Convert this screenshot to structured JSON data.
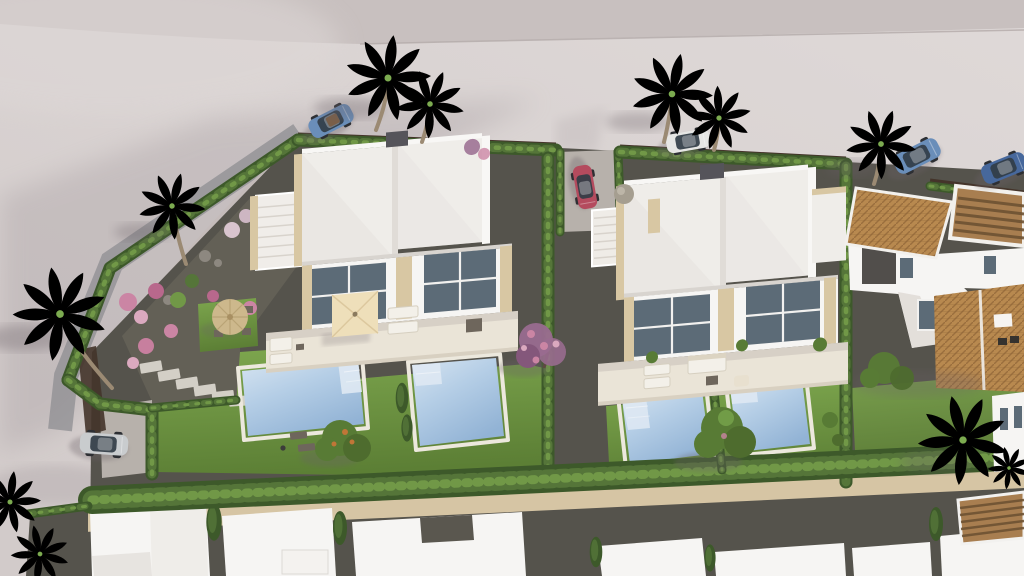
{
  "scene": {
    "description": "Aerial 3D architectural rendering of a Mediterranean residential development: two modern white semi-detached villas with private pools and lawns, cypress hedges, palm trees, gravel gardens with flowering shrubs, parked cars on a curved light-grey street, a terracotta-tile-roof house on the right and a row of flat white roofs along the bottom",
    "type": "3d-render-aerial-view",
    "visible_text": ""
  },
  "objects": {
    "villas": [
      "white-villa-left-two-units",
      "white-villa-right-two-units"
    ],
    "other_buildings": [
      "terracotta-roof-house-right",
      "flat-white-roofs-bottom-row"
    ],
    "pools": 4,
    "cars": [
      "blue-convertible",
      "white-hatchback",
      "red-compact",
      "silver-suv",
      "blue-suv",
      "dark-blue-suv"
    ],
    "vegetation": [
      "palm-trees",
      "cypress-hedges",
      "pink-bougainvillea",
      "green-trees",
      "lawns",
      "banana-plant"
    ],
    "garden_features": [
      "round-straw-parasol",
      "square-cream-parasol",
      "stepping-stones",
      "sun-loungers",
      "outdoor-sofa",
      "external-stairs",
      "stone-ball"
    ]
  },
  "palette": {
    "pavement": "#d2cbca",
    "pavementLight": "#ded8d7",
    "pavementShadow": "#9f959a",
    "topBand": "#c8c0bf",
    "curb": "#c3bbb8",
    "asphaltEdge": "#8e8d92",
    "gravel": "#55534c",
    "gravelLight": "#636056",
    "pebble": "#8d8880",
    "sand": "#d6c5a4",
    "lawnLight": "#7da64e",
    "lawnDark": "#5c7f35",
    "hedge": "#557539",
    "hedgeLight": "#719847",
    "hedgeDark": "#3d592a",
    "palm": "#5d8038",
    "palmDark": "#486a2c",
    "palmLight": "#7cab50",
    "trunk": "#9b8a73",
    "white": "#f6f5f3",
    "roofWhite": "#efede9",
    "roofShade": "#e0dcd7",
    "parapet": "#d8c7a3",
    "glazing": "#5c6b77",
    "frame": "#f2f1ef",
    "terrace": "#eae4d7",
    "terraceEdge": "#d8d0c1",
    "poolLight": "#d6e4f1",
    "poolMid": "#b5cee6",
    "poolDeep": "#92b3d5",
    "coping": "#ece8dd",
    "steps": "#dfe9f3",
    "terracotta": "#b8894f",
    "terracottaDark": "#8a5f33",
    "pergola": "#a87e50",
    "pergolaDark": "#6e5233",
    "fence": "#44342a",
    "carGlass": "#323d47",
    "carBlue": "#6a8eb9",
    "carDarkBlue": "#47689c",
    "carRed": "#b44b5e",
    "carSilver": "#c9ccce",
    "carWhite": "#e6e6e4",
    "treePurple": "#996b8f",
    "treePink": "#cb85a4",
    "treeGreen": "#587b35",
    "fruit": "#c07637",
    "shadow": "#6b6166",
    "concrete": "#b7b1ab",
    "stoneBall": "#a59e90",
    "furnDark": "#6e665c",
    "furnLight": "#f3f0e9",
    "straw": "#cdb88c",
    "chimney": "#55545a"
  }
}
